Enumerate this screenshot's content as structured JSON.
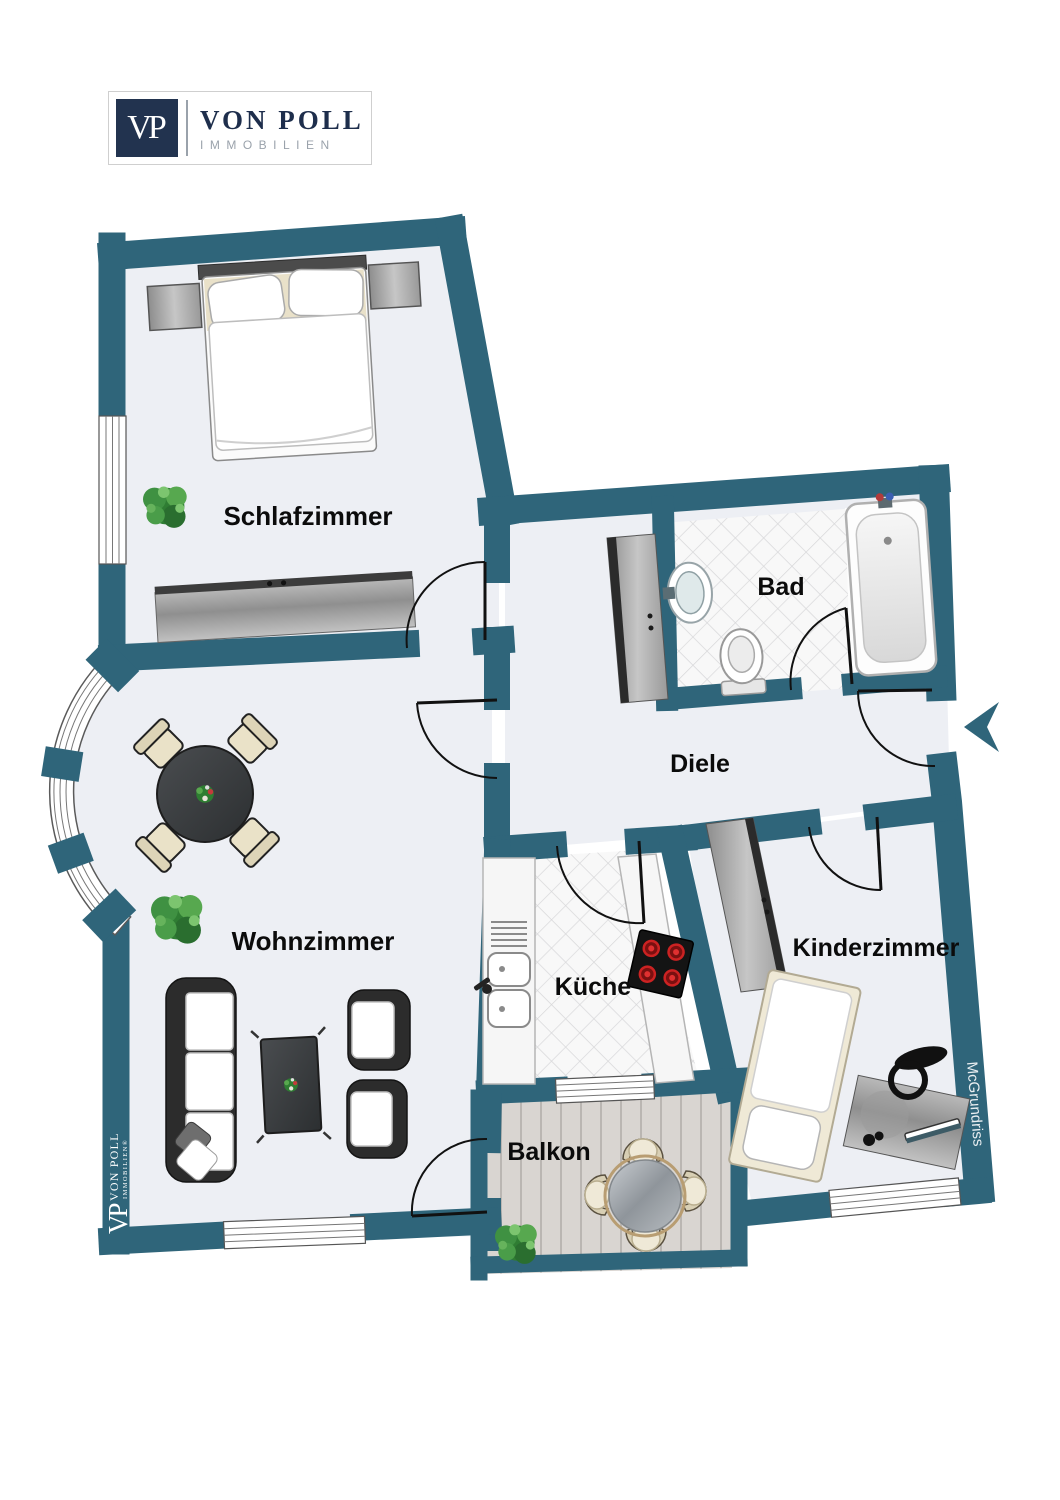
{
  "brand": {
    "initials": "VP",
    "name": "VON POLL",
    "subtitle": "IMMOBILIEN"
  },
  "plan": {
    "rooms": [
      {
        "id": "schlafzimmer",
        "label": "Schlafzimmer"
      },
      {
        "id": "bad",
        "label": "Bad"
      },
      {
        "id": "diele",
        "label": "Diele"
      },
      {
        "id": "wohnzimmer",
        "label": "Wohnzimmer"
      },
      {
        "id": "kueche",
        "label": "Küche"
      },
      {
        "id": "kinderzimmer",
        "label": "Kinderzimmer"
      },
      {
        "id": "balkon",
        "label": "Balkon"
      }
    ],
    "credit": "McGrundriss",
    "watermark": {
      "initials": "VP",
      "name": "VON POLL",
      "subtitle": "IMMOBILIEN®"
    }
  },
  "colors": {
    "wall": "#2f657a",
    "floor": "#edeff4",
    "tile_bg": "#f8f8f8",
    "tile_line": "#d8d8da",
    "plank": "#d9d5d1",
    "brand_navy": "#1e2e4c",
    "brand_gray": "#9aa2ab"
  }
}
